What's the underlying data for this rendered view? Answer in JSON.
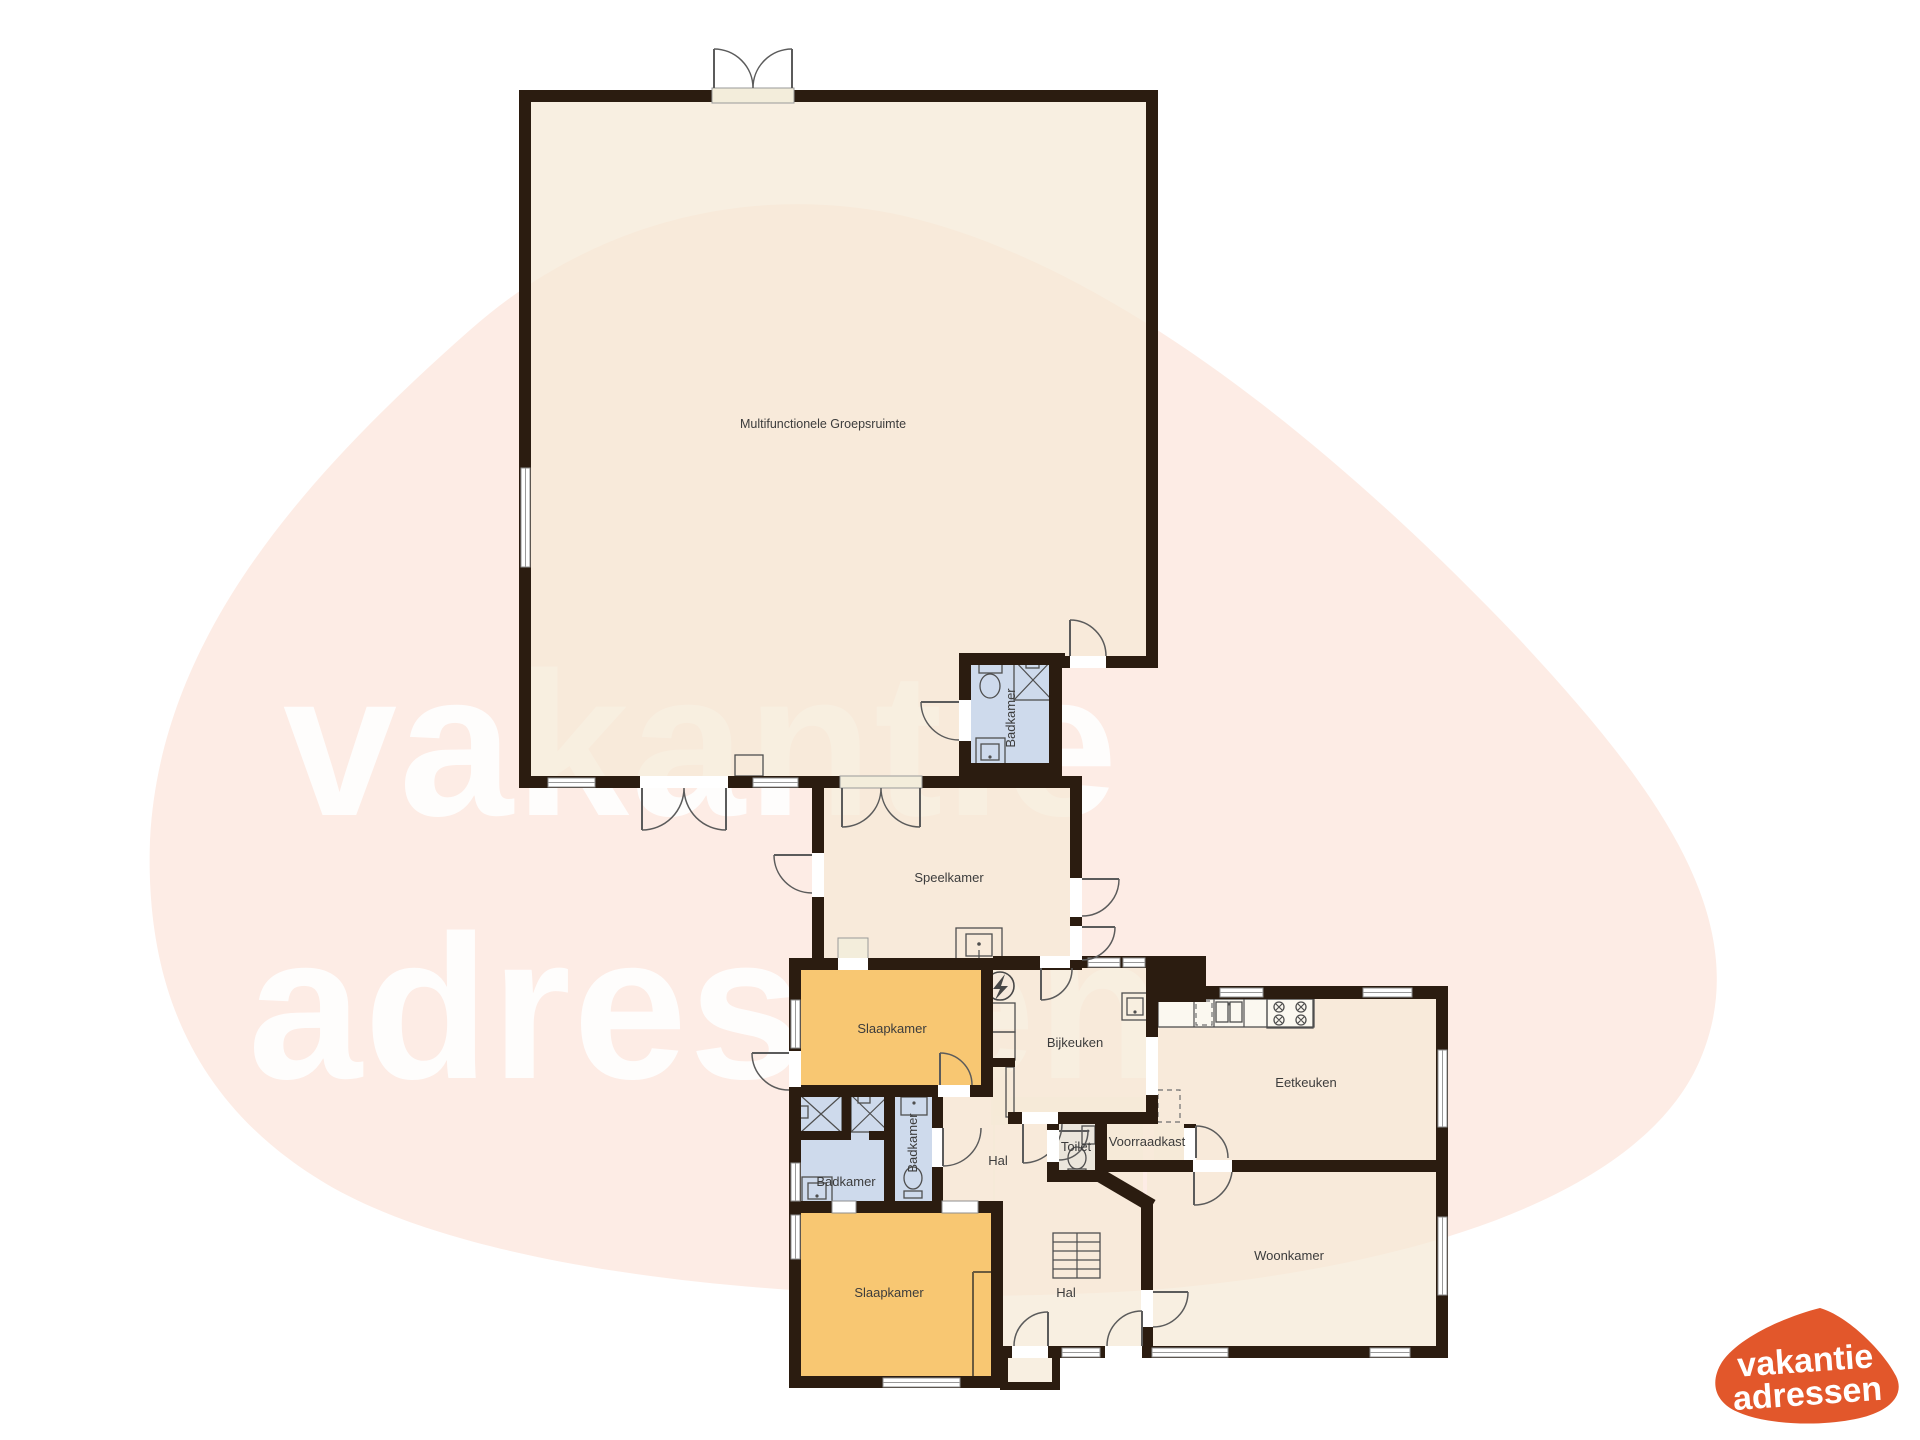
{
  "watermark": {
    "line1": "vakantie",
    "line2": "adressen"
  },
  "logo": {
    "line1": "vakantie",
    "line2": "adressen"
  },
  "colors": {
    "wall": "#2b1c10",
    "room_fill": "rgba(245,233,215,0.74)",
    "bedroom": "#f8c772",
    "bathroom": "#cedaec",
    "label": "#3c3c3c",
    "wm_blob": "#fdece5",
    "wm_text": "#ffffff",
    "logo_blob": "#e2572b",
    "logo_text": "#ffffff"
  },
  "rooms": {
    "groepsruimte": "Multifunctionele Groepsruimte",
    "speelkamer": "Speelkamer",
    "badkamer_top": "Badkamer",
    "slaapkamer_1": "Slaapkamer",
    "bijkeuken": "Bijkeuken",
    "eetkeuken": "Eetkeuken",
    "badkamer_left": "Badkamer",
    "badkamer_mid": "Badkamer",
    "toilet": "Toilet",
    "voorraadkast": "Voorraadkast",
    "hal_boven": "Hal",
    "hal_onder": "Hal",
    "slaapkamer_2": "Slaapkamer",
    "woonkamer": "Woonkamer"
  }
}
